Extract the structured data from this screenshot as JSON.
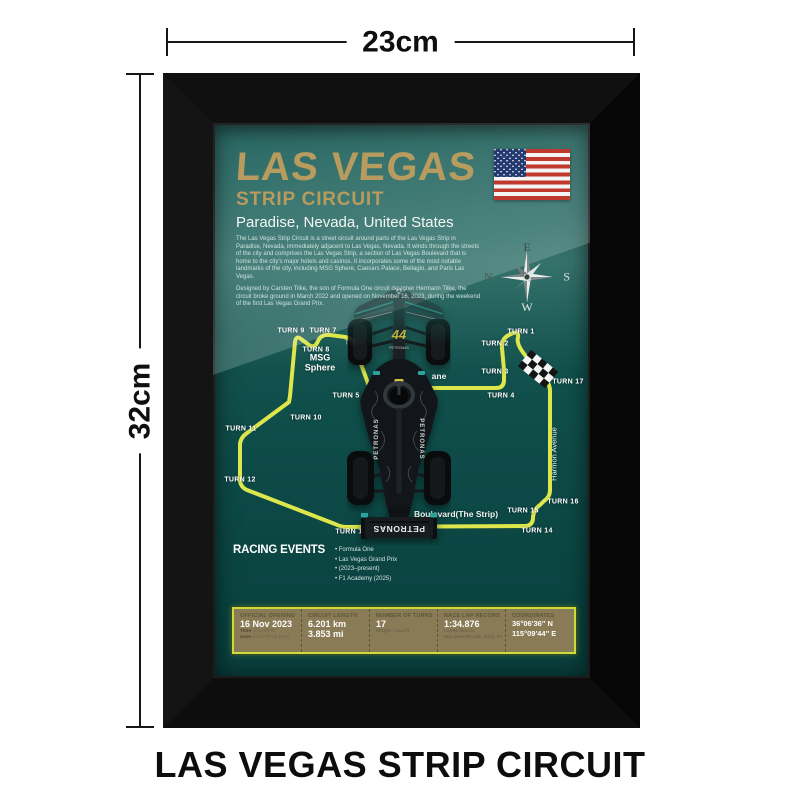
{
  "product": {
    "width_label": "23cm",
    "height_label": "32cm",
    "caption": "LAS VEGAS STRIP CIRCUIT"
  },
  "poster": {
    "title": "LAS VEGAS",
    "subtitle": "STRIP CIRCUIT",
    "location": "Paradise, Nevada, United States",
    "intro": "The Las Vegas Strip Circuit is a street circuit around parts of the Las Vegas Strip in Paradise, Nevada, immediately adjacent to Las Vegas, Nevada. It winds through the streets of the city and comprises the Las Vegas Strip, a section of Las Vegas Boulevard that is home to the city's major hotels and casinos. It incorporates some of the most notable landmarks of the city, including MSG Sphere, Caesars Palace, Bellagio, and Paris Las Vegas.",
    "history": "Designed by Carsten Tilke, the son of Formula One circuit designer Hermann Tilke, the circuit broke ground in March 2022 and opened on November 16, 2023, during the weekend of the first Las Vegas Grand Prix.",
    "compass": {
      "north": "N",
      "east": "E",
      "south": "S",
      "west": "W"
    },
    "map": {
      "track_color": "#dde74b",
      "path": "M156,263 L141,222 Q139,215 132,214 L117,212 Q108,211 105,218 Q102,226 96,222 L88,216 Q83,212 82,219 L77,273 L76,279 L34,310 Q27,315 27,322 L27,356 Q27,364 34,367 L122,401 Q128,404 134,404 L312,403 Q319,403 320,396 L320,394 Q321,386 327,382 L331,378 Q337,374 337,367 L337,268 Q337,261 332,256 L312,232 Q303,221 305,214 Q306,207 298,211 Q288,215 289,225 L291,247 L291,257 Q291,265 283,265 L163,265 Q157,265 156,263 Z",
      "turns": [
        {
          "label": "TURN 1",
          "x": 308,
          "y": 209
        },
        {
          "label": "TURN 2",
          "x": 282,
          "y": 221
        },
        {
          "label": "TURN 3",
          "x": 282,
          "y": 249
        },
        {
          "label": "TURN 4",
          "x": 288,
          "y": 273
        },
        {
          "label": "TURN 5",
          "x": 133,
          "y": 273
        },
        {
          "label": "TURN 6",
          "x": 145,
          "y": 220,
          "ghost": true
        },
        {
          "label": "TURN 7",
          "x": 110,
          "y": 208
        },
        {
          "label": "TURN 8",
          "x": 103,
          "y": 227
        },
        {
          "label": "TURN 9",
          "x": 78,
          "y": 208
        },
        {
          "label": "TURN 10",
          "x": 93,
          "y": 295
        },
        {
          "label": "TURN 11",
          "x": 28,
          "y": 306
        },
        {
          "label": "TURN 12",
          "x": 27,
          "y": 357
        },
        {
          "label": "TURN 13",
          "x": 138,
          "y": 409
        },
        {
          "label": "TURN 14",
          "x": 324,
          "y": 408
        },
        {
          "label": "TURN 15",
          "x": 310,
          "y": 388
        },
        {
          "label": "TURN 16",
          "x": 350,
          "y": 379
        },
        {
          "label": "TURN 17",
          "x": 355,
          "y": 259
        }
      ],
      "streets": [
        {
          "label": "Harmon Avenue",
          "x": 341,
          "y": 331,
          "rotate": -90,
          "bold": false
        },
        {
          "label": "Boulevard(The Strip)",
          "x": 243,
          "y": 391,
          "rotate": 0,
          "bold": true
        },
        {
          "label": "ane",
          "x": 226,
          "y": 253,
          "rotate": 0,
          "bold": true
        }
      ],
      "landmark": {
        "line1": "MSG",
        "line2": "Sphere",
        "x": 107,
        "y": 240
      }
    },
    "events": {
      "heading": "RACING EVENTS",
      "items": [
        "Formula One",
        "Las Vegas Grand Prix",
        "(2023–present)",
        "F1 Academy (2025)"
      ]
    },
    "info": {
      "columns": [
        {
          "header": "OFFICIAL OPENING",
          "lines": [
            {
              "text": "16 Nov 2023",
              "style": "big"
            }
          ],
          "pairs": [
            [
              "Time",
              "UTC-08:00"
            ],
            [
              "zone",
              "(UTC-07:00 DST)"
            ]
          ]
        },
        {
          "header": "CIRCUIT LENGTH",
          "lines": [
            {
              "text": "6.201 km",
              "style": "big"
            },
            {
              "text": "3.853 mi",
              "style": "big"
            }
          ]
        },
        {
          "header": "NUMBER OF TURNS",
          "lines": [
            {
              "text": "17",
              "style": "big"
            },
            {
              "text": "6Right - 11Left",
              "style": "muted"
            }
          ]
        },
        {
          "header": "RACE LAP RECORD",
          "lines": [
            {
              "text": "1:34.876",
              "style": "big"
            },
            {
              "text": "Lando Norris,",
              "style": "muted"
            },
            {
              "text": "McLaren MCL38, 2024, F1",
              "style": "muted"
            }
          ]
        },
        {
          "header": "COORDINATES",
          "lines": [
            {
              "text": "36°06′36″ N",
              "style": "big2"
            },
            {
              "text": "115°09′44″ E",
              "style": "big2"
            }
          ]
        }
      ]
    },
    "car": {
      "number": "44",
      "sponsor": "PETRONAS"
    }
  },
  "colors": {
    "gold": "#b89b5f",
    "track_yellow": "#dde74b",
    "teal_dark": "#0c4845",
    "teal_light": "#4e8680",
    "table_bg": "#8a7b57",
    "table_border": "#c9dc3a"
  }
}
